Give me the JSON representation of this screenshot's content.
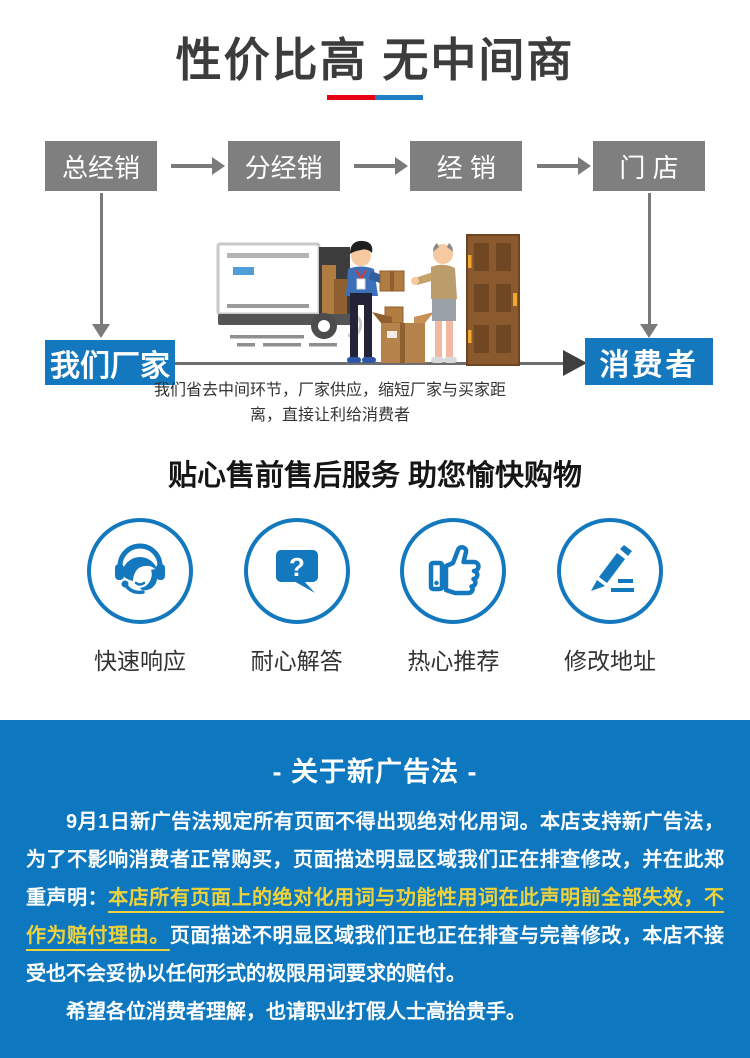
{
  "title": {
    "text": "性价比高 无中间商"
  },
  "flow": {
    "top_boxes": [
      "总经销",
      "分经销",
      "经 销",
      "门 店"
    ],
    "left_box": "我们厂家",
    "right_box": "消费者",
    "caption_line1": "我们省去中间环节，厂家供应，缩短厂家与买家距",
    "caption_line2": "离，直接让利给消费者"
  },
  "services": {
    "title": "贴心售前售后服务 助您愉快购物",
    "items": [
      {
        "label": "快速响应",
        "icon": "headset-agent-icon",
        "glyph": ""
      },
      {
        "label": "耐心解答",
        "icon": "question-bubble-icon",
        "glyph": "?"
      },
      {
        "label": "热心推荐",
        "icon": "thumbs-up-icon",
        "glyph": ""
      },
      {
        "label": "修改地址",
        "icon": "pencil-icon",
        "glyph": ""
      }
    ]
  },
  "notice": {
    "title": "- 关于新广告法 -",
    "p1_part1": "9月1日新广告法规定所有页面不得出现绝对化用词。本店支持新广告法，为了不影响消费者正常购买，页面描述明显区域我们正在排查修改，并在此郑重声明：",
    "p1_highlight": "本店所有页面上的绝对化用词与功能性用词在此声明前全部失效，不作为赔付理由。",
    "p1_part2": "页面描述不明显区域我们正也正在排查与完善修改，本店不接受也不会妥协以任何形式的极限用词要求的赔付。",
    "p2": "希望各位消费者理解，也请职业打假人士高抬贵手。"
  },
  "colors": {
    "accent_blue": "#1378bd",
    "section_blue": "#0d78c0",
    "box_gray": "#7f7f7f",
    "arrow_gray": "#7a7a7a",
    "arrowhead_dark": "#3f3f3f",
    "underline_red": "#e60012",
    "underline_blue": "#1f7ec4",
    "highlight_yellow": "#eed23c",
    "title_color": "#3c3c3c",
    "body_text": "#333333"
  }
}
